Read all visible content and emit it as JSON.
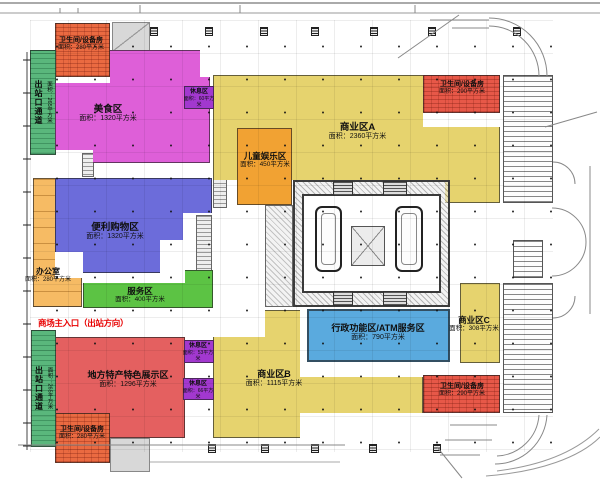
{
  "plan": {
    "entrance": {
      "label": "商场主入口（出站方向）",
      "color": "#e80000"
    },
    "zones": {
      "wc_top_left": {
        "name": "卫生间/设备房",
        "area": "面积：280平方米",
        "color": "#ea6a41"
      },
      "wc_top_right": {
        "name": "卫生间/设备房",
        "area": "面积：290平方米",
        "color": "#e75848"
      },
      "wc_bottom_left": {
        "name": "卫生间/设备房",
        "area": "面积：280平方米",
        "color": "#ea6a41"
      },
      "wc_bottom_right": {
        "name": "卫生间/设备房",
        "area": "面积：290平方米",
        "color": "#e75848"
      },
      "exit_corridor_top": {
        "name": "出站口通道",
        "area": "面积：265平方米",
        "color": "#5ab77c"
      },
      "exit_corridor_bottom": {
        "name": "出站口通道",
        "area": "面积：265平方米",
        "color": "#5ab77c"
      },
      "food": {
        "name": "美食区",
        "area": "面积：1320平方米",
        "color": "#de5fd8"
      },
      "convenience": {
        "name": "便利购物区",
        "area": "面积：1320平方米",
        "color": "#6c6cda"
      },
      "service": {
        "name": "服务区",
        "area": "面积：400平方米",
        "color": "#5cc344"
      },
      "office": {
        "name": "办公室",
        "area": "面积：280平方米",
        "color": "#f6bb64"
      },
      "local_specialty": {
        "name": "地方特产特色展示区",
        "area": "面积：1296平方米",
        "color": "#e46060"
      },
      "children": {
        "name": "儿童娱乐区",
        "area": "面积：450平方米",
        "color": "#f1a233"
      },
      "commercial_a": {
        "name": "商业区A",
        "area": "面积：2360平方米",
        "color": "#e6d36e"
      },
      "commercial_b": {
        "name": "商业区B",
        "area": "面积：1115平方米",
        "color": "#e6d36e"
      },
      "commercial_c": {
        "name": "商业区C",
        "area": "面积：308平方米",
        "color": "#e6d36e"
      },
      "admin_atm": {
        "name": "行政功能区/ATM服务区",
        "area": "面积：790平方米",
        "color": "#5aaade"
      },
      "rest_top": {
        "name": "休息区",
        "area": "面积：60平方米",
        "color": "#a238cf"
      },
      "rest_middle": {
        "name": "休息区",
        "area": "面积：53平方米",
        "color": "#a238cf"
      },
      "rest_bottom": {
        "name": "休息区",
        "area": "面积：66平方米",
        "color": "#a238cf"
      }
    }
  }
}
